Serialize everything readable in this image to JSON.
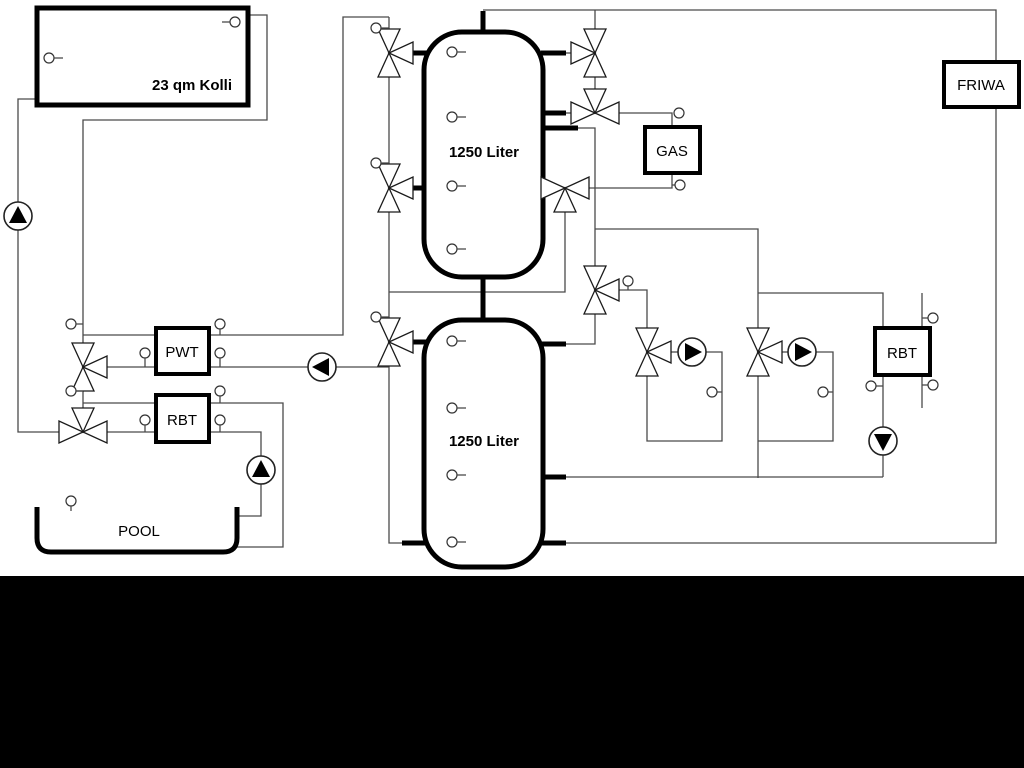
{
  "diagram": {
    "type": "hydraulic-schematic",
    "background_color": "#ffffff",
    "bottom_band_color": "#000000",
    "pipe_color": "#4a4a4a",
    "component_outline_color": "#000000"
  },
  "components": {
    "collector": {
      "label": "23 qm Kolli"
    },
    "buffer_tank_top": {
      "label": "1250 Liter"
    },
    "buffer_tank_bottom": {
      "label": "1250 Liter"
    },
    "gas_boiler": {
      "label": "GAS"
    },
    "friwa": {
      "label": "FRIWA"
    },
    "pwt": {
      "label": "PWT"
    },
    "rbt_left": {
      "label": "RBT"
    },
    "rbt_right": {
      "label": "RBT"
    },
    "pool": {
      "label": "POOL"
    }
  }
}
